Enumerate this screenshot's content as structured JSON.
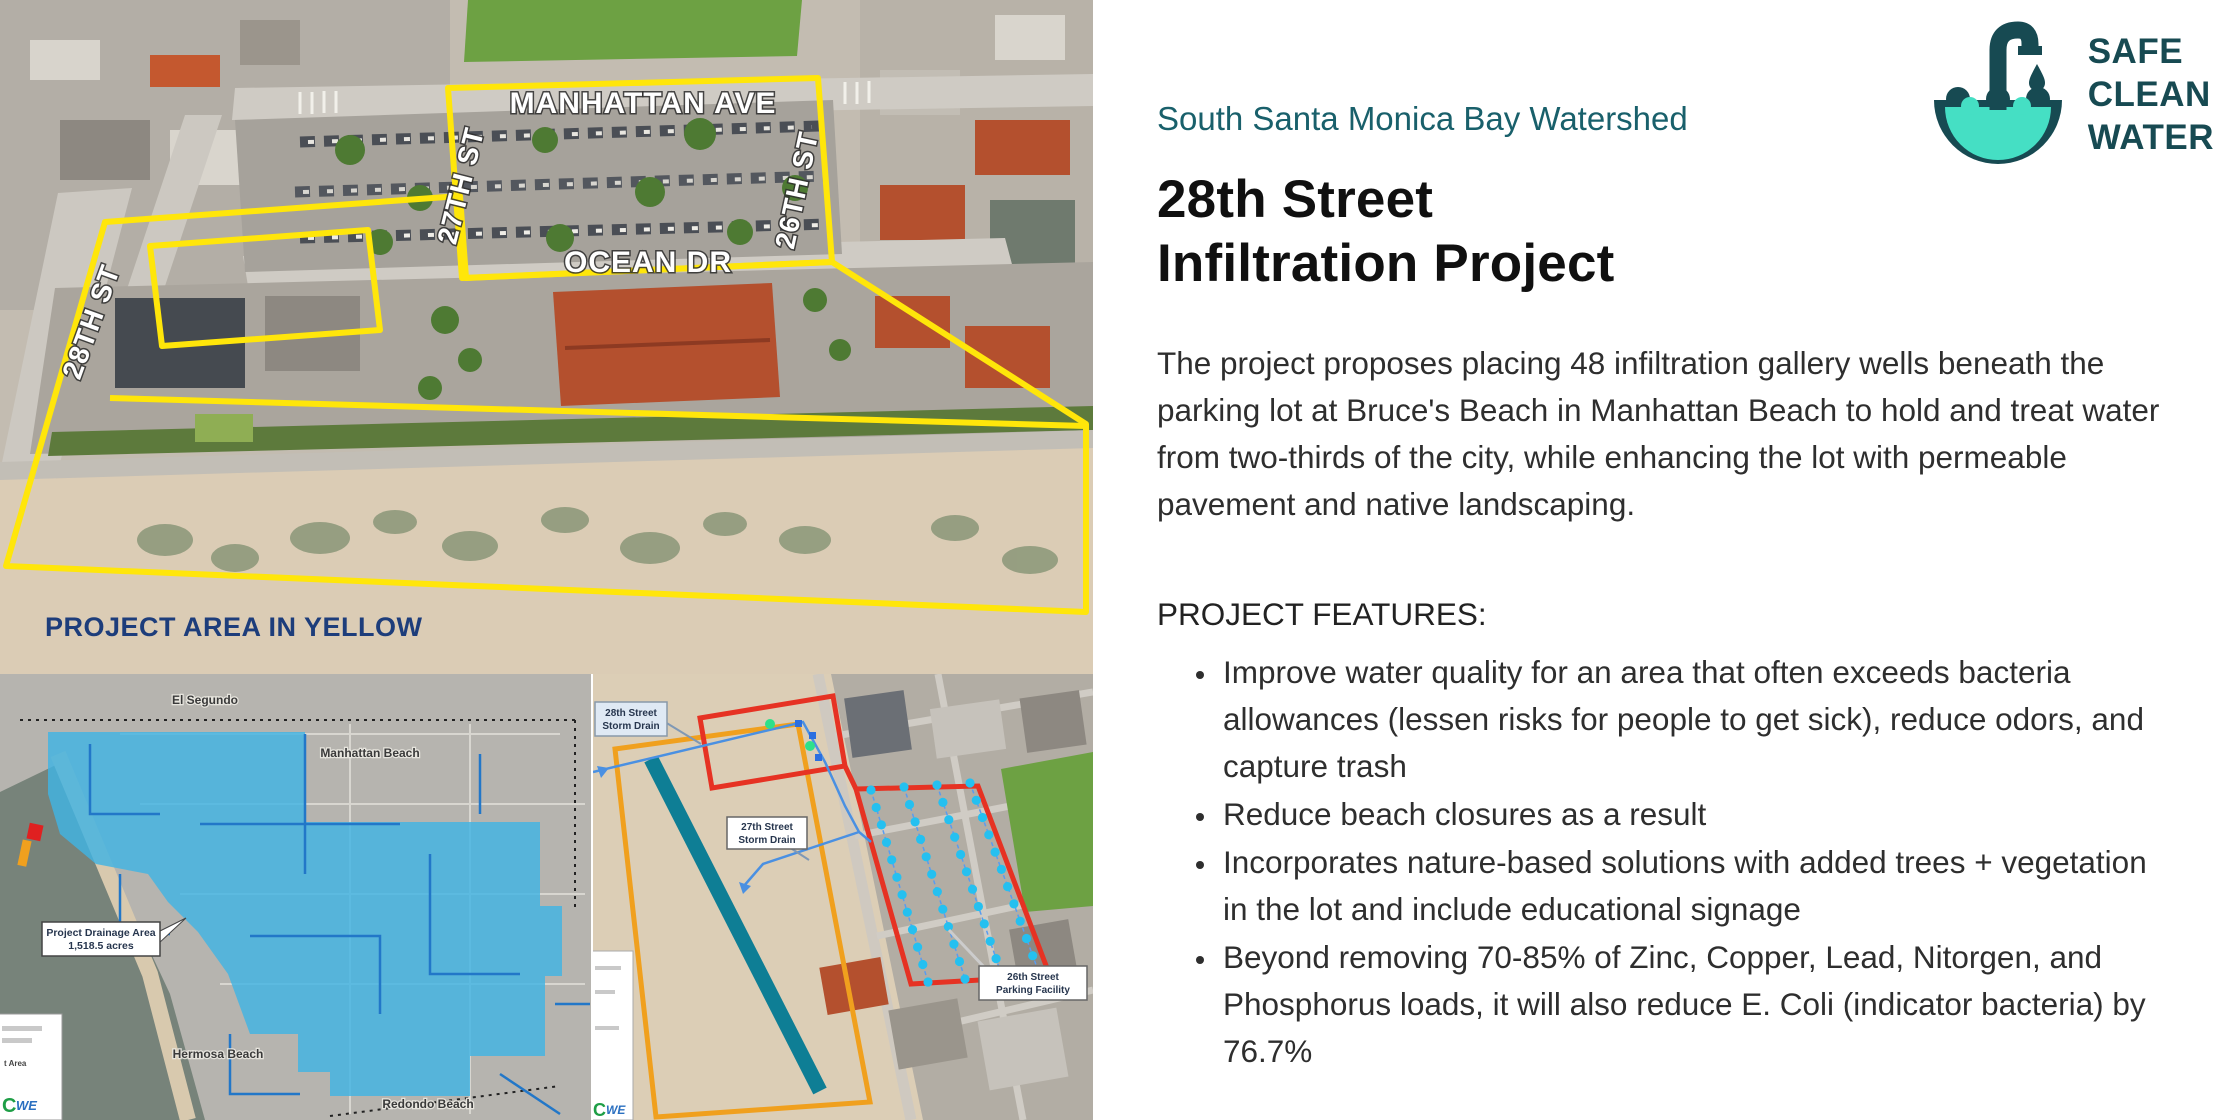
{
  "logo": {
    "line1": "SAFE",
    "line2": "CLEAN",
    "line3": "WATER"
  },
  "right_panel": {
    "eyebrow": "South Santa Monica Bay Watershed",
    "title_line1": "28th Street",
    "title_line2": "Infiltration Project",
    "paragraph": "The project proposes placing 48 infiltration gallery wells beneath the parking lot at Bruce's Beach in Manhattan Beach to hold and treat water from two-thirds of the city, while enhancing the lot with permeable pavement and native landscaping.",
    "features_heading": "PROJECT FEATURES:",
    "features": [
      "Improve water quality for an area that often exceeds bacteria allowances (lessen risks for people to get sick), reduce odors, and capture trash",
      "Reduce beach closures as a result",
      "Incorporates nature-based solutions with added trees + vegetation in the lot and include educational signage",
      "Beyond removing 70-85% of Zinc, Copper, Lead, Nitorgen, and Phosphorus loads, it will also reduce E. Coli (indicator bacteria) by 76.7%"
    ]
  },
  "aerial_map": {
    "street_labels": {
      "manhattan_ave": "MANHATTAN AVE",
      "street_27": "27TH ST",
      "street_26": "26TH ST",
      "ocean_dr": "OCEAN DR",
      "street_28": "28TH ST"
    },
    "caption": "PROJECT AREA IN YELLOW"
  },
  "drainage_map": {
    "city_labels": {
      "el_segundo": "El Segundo",
      "manhattan_beach": "Manhattan Beach",
      "hermosa_beach": "Hermosa Beach",
      "redondo_beach": "Redondo Beach"
    },
    "callout_line1": "Project Drainage Area",
    "callout_line2": "1,518.5 acres",
    "legend_partial_text": "t Area",
    "legend_logo_c": "C",
    "legend_logo_we": "WE"
  },
  "site_map": {
    "labels": {
      "storm_drain_28": {
        "line1": "28th Street",
        "line2": "Storm Drain"
      },
      "storm_drain_27": {
        "line1": "27th Street",
        "line2": "Storm Drain"
      },
      "parking_26": {
        "line1": "26th Street",
        "line2": "Parking Facility"
      }
    },
    "legend_logo_c": "C",
    "legend_logo_we": "WE",
    "wells": {
      "count": 48,
      "columns": [
        {
          "n": 12,
          "x1": 278,
          "y1": 116,
          "x2": 335,
          "y2": 308
        },
        {
          "n": 12,
          "x1": 311,
          "y1": 113,
          "x2": 372,
          "y2": 305
        },
        {
          "n": 12,
          "x1": 344,
          "y1": 111,
          "x2": 409,
          "y2": 302
        },
        {
          "n": 12,
          "x1": 377,
          "y1": 109,
          "x2": 446,
          "y2": 299
        }
      ]
    }
  },
  "colors": {
    "brand_teal": "#174A52",
    "water_teal": "#45DFC4",
    "eyebrow_teal": "#19606B",
    "caption_navy": "#1D3D7B",
    "project_outline_yellow": "#FFE60A",
    "drainage_fill": "#41B3E3",
    "drain_line_blue": "#2277C8",
    "storm_drain_teal": "#0E7E95",
    "red_outline": "#E63223",
    "orange_outline": "#F0A01E",
    "well_dot": "#25C0F0",
    "green_dot": "#2EE08A"
  }
}
